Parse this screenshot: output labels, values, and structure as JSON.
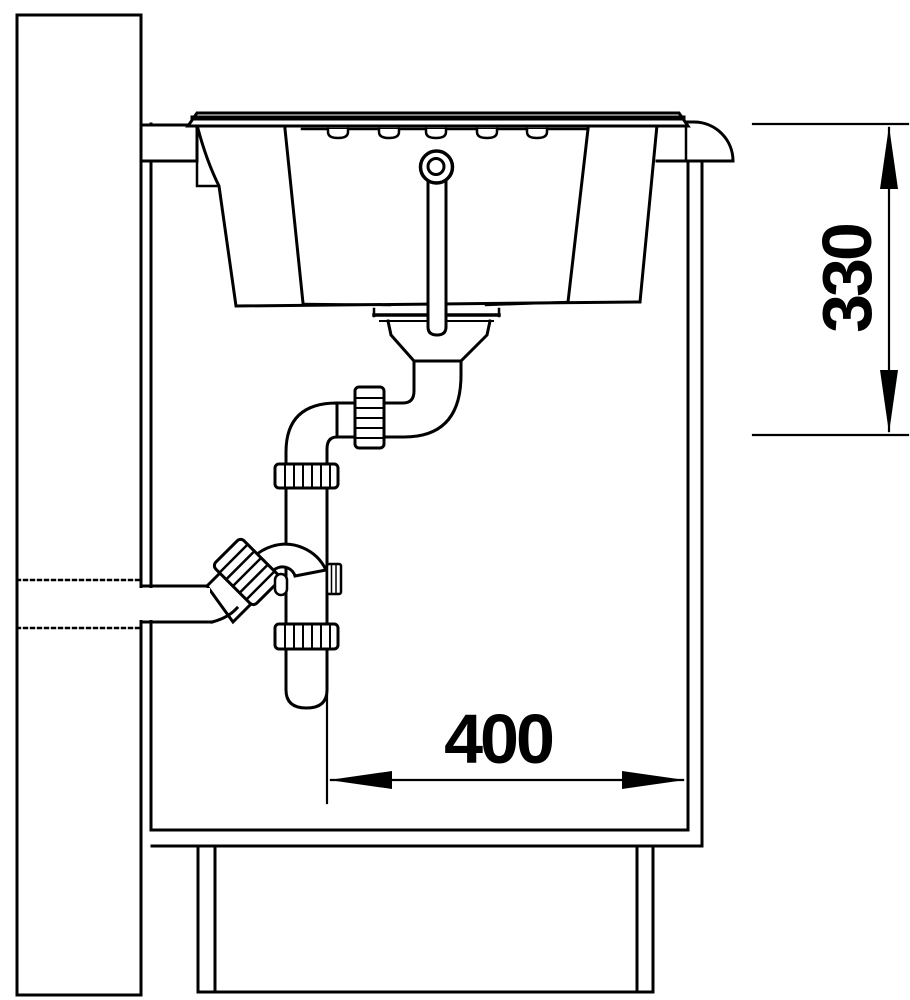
{
  "drawing": {
    "kind": "sink-installation-section",
    "dimensions": {
      "vertical": "330",
      "horizontal": "400"
    },
    "colors": {
      "line": "#000000",
      "background": "#ffffff"
    }
  }
}
